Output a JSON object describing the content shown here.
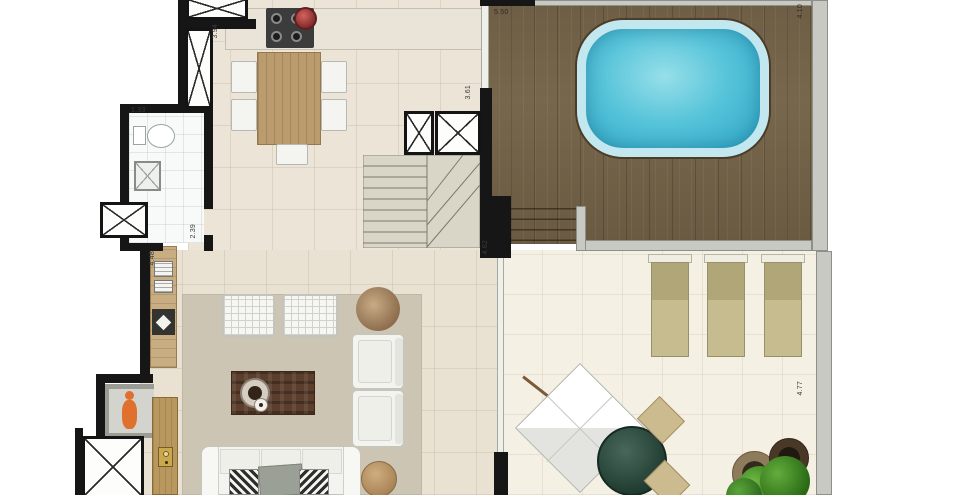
{
  "plan": {
    "type": "penthouse-floor-plan",
    "dimensions": [
      {
        "id": "kitchen-shaft-wall",
        "text": "3.94",
        "orientation": "vertical"
      },
      {
        "id": "bathroom-width",
        "text": "1.33",
        "orientation": "horizontal"
      },
      {
        "id": "bathroom-depth",
        "text": "2.39",
        "orientation": "vertical"
      },
      {
        "id": "living-left-wall",
        "text": "4.48",
        "orientation": "vertical"
      },
      {
        "id": "kitchen-right-wall",
        "text": "3.61",
        "orientation": "vertical"
      },
      {
        "id": "stair-wall",
        "text": "4.62",
        "orientation": "vertical"
      },
      {
        "id": "pool-deck-width",
        "text": "5.50",
        "orientation": "horizontal"
      },
      {
        "id": "pool-deck-right",
        "text": "4.10",
        "orientation": "vertical"
      },
      {
        "id": "terrace-right-wall",
        "text": "4.77",
        "orientation": "vertical"
      }
    ],
    "palette": {
      "wall": "#161616",
      "floor_interior": "#ece5d7",
      "floor_bathroom": "#f8faf9",
      "floor_terrace": "#f4f0e3",
      "rug": "#cdc5b4",
      "deck_wood": "#73634a",
      "pool_water": "#45b9d4",
      "pool_coping": "#c3e7ef",
      "lounger": "#c2b88a",
      "sofa_white": "#f3f3f0",
      "dining_table_wood": "#bb9c6e",
      "coffee_table_wood": "#5b3e2c",
      "elevator_person": "#e0702e",
      "patio_table_green": "#2c4a3d"
    },
    "objects": [
      "pool",
      "wooden-deck",
      "deck-steps",
      "sun-lounger",
      "sun-terrace",
      "parasol-dining-set",
      "round-pouf",
      "terrace-plant",
      "sliding-glass-door",
      "staircase",
      "service-shaft",
      "kitchen-counter",
      "cooktop",
      "cooking-pot",
      "dining-table",
      "dining-chair",
      "toilet",
      "shower-box",
      "elevator",
      "elevator-passenger",
      "entry-door",
      "sideboard",
      "living-rug",
      "ottoman",
      "dry-plant",
      "coffee-table",
      "armchair",
      "sofa",
      "side-table"
    ]
  }
}
